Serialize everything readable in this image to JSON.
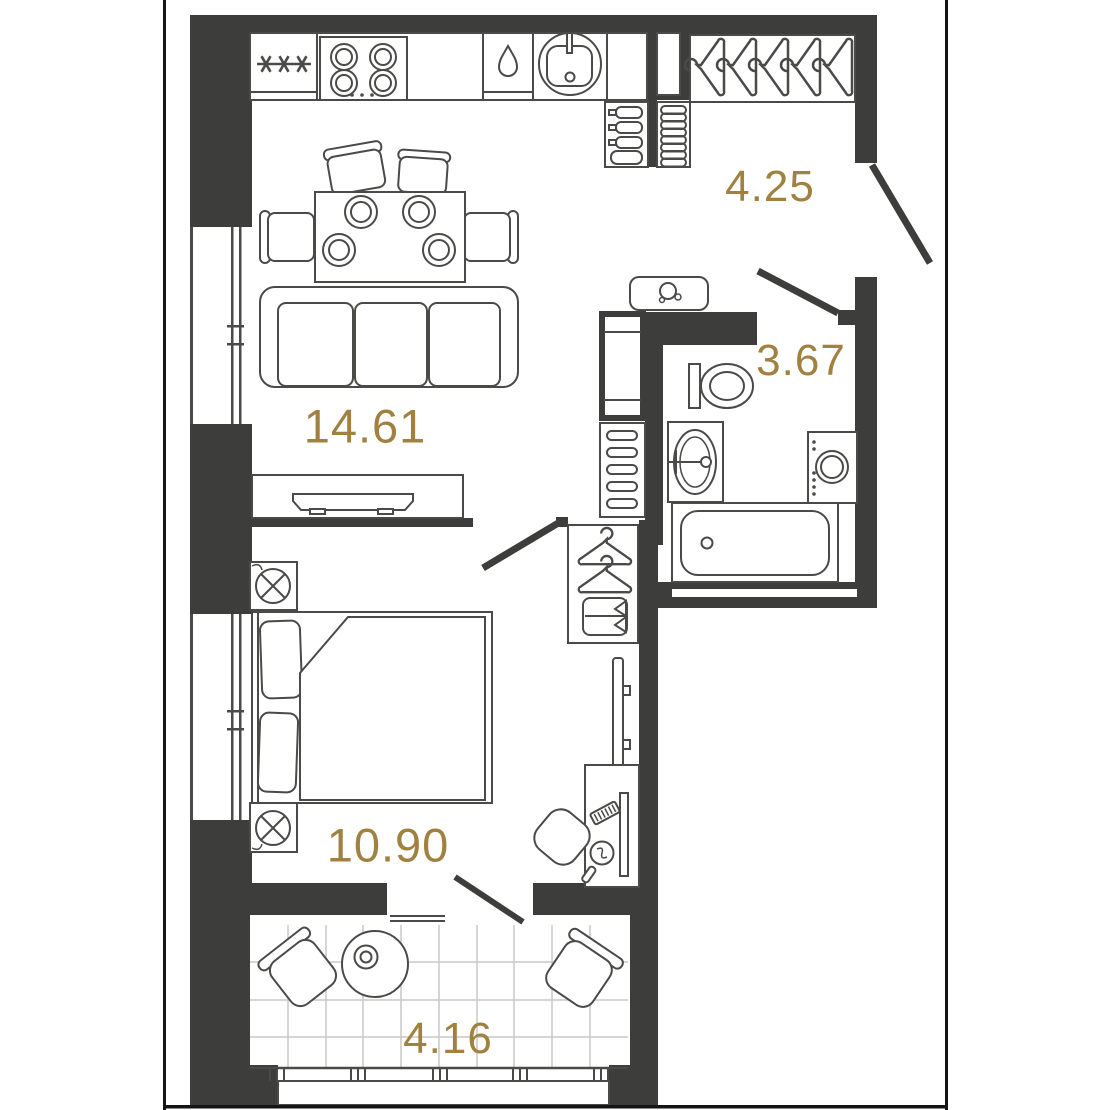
{
  "plan": {
    "title": "one-bedroom apartment floor plan",
    "rooms": [
      {
        "name": "kitchen-living-room",
        "area": "14.61"
      },
      {
        "name": "bedroom",
        "area": "10.90"
      },
      {
        "name": "hallway",
        "area": "4.25"
      },
      {
        "name": "bathroom",
        "area": "3.67"
      },
      {
        "name": "balcony",
        "area": "4.16"
      }
    ],
    "colors": {
      "wall": "#3d3d3c",
      "furniture_outline": "#4a4a48",
      "area_label": "#a18140",
      "background": "#ffffff",
      "frame": "#141414",
      "balcony_tile_grid": "#c9c9c7"
    },
    "icons": {
      "fridge_frost_symbol": "✳ ✳ ✳",
      "stove": "burners-x4",
      "dishwasher": "water-drop",
      "kitchen_sink": "round-sink-with-tap",
      "hall_wardrobe": "hangers-x5",
      "bottle_rack": "bottles-x4",
      "shoe_rack": "shoe-pairs-x4",
      "water_heater": "boiler-with-shower-head",
      "toilet": "tank-and-bowl",
      "bath_sink": "oval-basin",
      "washing_machine": "front-door-drum",
      "bathtub": "rect-tub-with-drain",
      "bedroom_closet": "hangers-x2-with-shelf",
      "bed": "double-bed-two-pillows",
      "nightstand_lamp": "circle-with-cross",
      "tv": "wall-panel",
      "vanity": "mirror-and-comb",
      "balcony_table": "round-table-with-pot"
    }
  }
}
